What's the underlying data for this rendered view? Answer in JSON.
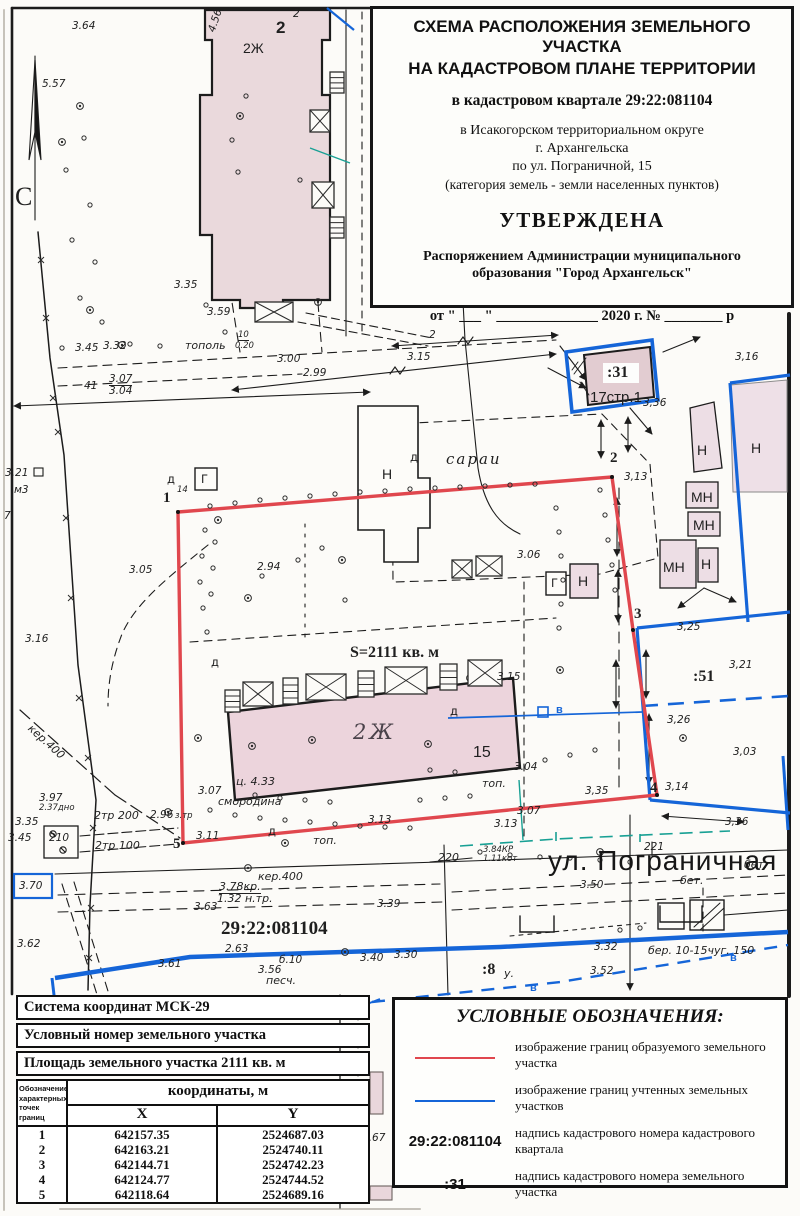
{
  "title_block": {
    "line1": "СХЕМА РАСПОЛОЖЕНИЯ ЗЕМЕЛЬНОГО УЧАСТКА",
    "line2": "НА КАДАСТРОВОМ ПЛАНЕ ТЕРРИТОРИИ",
    "quarter": "в кадастровом квартале 29:22:081104",
    "district": "в Исакогорском территориальном округе",
    "city": "г. Архангельска",
    "address": "по ул. Пограничной, 15",
    "category": "(категория земель - земли населенных пунктов)",
    "approved": "УТВЕРЖДЕНА",
    "order1": "Распоряжением Администрации муниципального",
    "order2": "образования \"Город Архангельск\"",
    "date_line": "от  \" ___ \"  ______________  2020 г.  №  ________  р"
  },
  "legend": {
    "title": "УСЛОВНЫЕ ОБОЗНАЧЕНИЯ:",
    "items": [
      {
        "type": "line-red",
        "label": "изображение границ образуемого земельного участка"
      },
      {
        "type": "line-blue",
        "label": "изображение границ учтенных земельных участков"
      },
      {
        "type": "text",
        "symbol": "29:22:081104",
        "label": "надпись кадастрового номера кадастрового квартала"
      },
      {
        "type": "text",
        "symbol": ":31",
        "label": "надпись кадастрового номера земельного участка"
      }
    ],
    "scale": "Масштаб  1 : 500"
  },
  "info_table": {
    "coord_system": "Система координат МСК-29",
    "cond_number": "Условный номер земельного участка",
    "area": "Площадь земельного участка 2111 кв. м",
    "points_header": "Обозначение характерных точек границ",
    "coords_header": "координаты, м",
    "col_x": "X",
    "col_y": "Y",
    "points": [
      {
        "n": "1",
        "x": "642157.35",
        "y": "2524687.03"
      },
      {
        "n": "2",
        "x": "642163.21",
        "y": "2524740.11"
      },
      {
        "n": "3",
        "x": "642144.71",
        "y": "2524742.23"
      },
      {
        "n": "4",
        "x": "642124.77",
        "y": "2524744.52"
      },
      {
        "n": "5",
        "x": "642118.64",
        "y": "2524689.16"
      }
    ]
  },
  "map": {
    "colors": {
      "parcel_new": "#e0474e",
      "parcel_registered": "#1565d8",
      "utility": "#18a094"
    },
    "labels": [
      {
        "t": "3.64",
        "x": 72,
        "y": 20,
        "c": ""
      },
      {
        "t": "5.57",
        "x": 42,
        "y": 78,
        "c": ""
      },
      {
        "t": "С",
        "x": 15,
        "y": 182,
        "c": "north"
      },
      {
        "t": "2",
        "x": 293,
        "y": 8,
        "c": ""
      },
      {
        "t": "2",
        "x": 276,
        "y": 18,
        "c": "nb2"
      },
      {
        "t": "2Ж",
        "x": 243,
        "y": 40,
        "c": "bld"
      },
      {
        "t": "4.56",
        "x": 206,
        "y": 30,
        "c": "",
        "r": -72
      },
      {
        "t": "3.35",
        "x": 174,
        "y": 279,
        "c": ""
      },
      {
        "t": "3.59",
        "x": 207,
        "y": 306,
        "c": ""
      },
      {
        "t": "3.45",
        "x": 75,
        "y": 342,
        "c": ""
      },
      {
        "t": "3.32",
        "x": 103,
        "y": 340,
        "c": ""
      },
      {
        "t": "тополь",
        "x": 185,
        "y": 339,
        "c": "hand"
      },
      {
        "t": "10",
        "x": 238,
        "y": 330,
        "c": "tiny frt"
      },
      {
        "t": "0.20",
        "x": 235,
        "y": 341,
        "c": "tiny"
      },
      {
        "t": "3.00",
        "x": 277,
        "y": 353,
        "c": ""
      },
      {
        "t": "2.99",
        "x": 303,
        "y": 367,
        "c": ""
      },
      {
        "t": "41",
        "x": 84,
        "y": 380,
        "c": ""
      },
      {
        "t": "3.07",
        "x": 109,
        "y": 373,
        "c": "frt"
      },
      {
        "t": "3.04",
        "x": 109,
        "y": 385,
        "c": ""
      },
      {
        "t": "2",
        "x": 429,
        "y": 329,
        "c": ""
      },
      {
        "t": "3.15",
        "x": 407,
        "y": 351,
        "c": ""
      },
      {
        "t": "3.21",
        "x": 5,
        "y": 467,
        "c": ""
      },
      {
        "t": "м3",
        "x": 14,
        "y": 484,
        "c": ""
      },
      {
        "t": "7",
        "x": 4,
        "y": 510,
        "c": ""
      },
      {
        "t": "3.05",
        "x": 129,
        "y": 564,
        "c": ""
      },
      {
        "t": "3.16",
        "x": 25,
        "y": 633,
        "c": ""
      },
      {
        "t": "1",
        "x": 163,
        "y": 490,
        "c": "nb"
      },
      {
        "t": "14",
        "x": 177,
        "y": 485,
        "c": "tiny"
      },
      {
        "t": "д",
        "x": 167,
        "y": 472,
        "c": "blds"
      },
      {
        "t": "Г",
        "x": 201,
        "y": 472,
        "c": "blds"
      },
      {
        "t": "2.94",
        "x": 257,
        "y": 561,
        "c": ""
      },
      {
        "t": "сараи",
        "x": 446,
        "y": 450,
        "c": "handlg"
      },
      {
        "t": "Н",
        "x": 382,
        "y": 466,
        "c": "bld"
      },
      {
        "t": "д",
        "x": 410,
        "y": 450,
        "c": "blds"
      },
      {
        "t": "3.06",
        "x": 517,
        "y": 549,
        "c": ""
      },
      {
        "t": "Г",
        "x": 551,
        "y": 576,
        "c": "blds"
      },
      {
        "t": "Н",
        "x": 578,
        "y": 573,
        "c": "bld"
      },
      {
        "t": "S=2111 кв. м",
        "x": 350,
        "y": 644,
        "c": "area"
      },
      {
        "t": ":31",
        "x": 607,
        "y": 364,
        "c": "pnum"
      },
      {
        "t": "17стр.1",
        "x": 590,
        "y": 389,
        "c": "b17"
      },
      {
        "t": "3,36",
        "x": 643,
        "y": 397,
        "c": ""
      },
      {
        "t": "3,16",
        "x": 735,
        "y": 351,
        "c": ""
      },
      {
        "t": "2",
        "x": 610,
        "y": 450,
        "c": "nb"
      },
      {
        "t": "3,13",
        "x": 624,
        "y": 471,
        "c": ""
      },
      {
        "t": "Н",
        "x": 697,
        "y": 442,
        "c": "bld"
      },
      {
        "t": "МН",
        "x": 691,
        "y": 489,
        "c": "bld"
      },
      {
        "t": "МН",
        "x": 693,
        "y": 517,
        "c": "bld"
      },
      {
        "t": "МН",
        "x": 663,
        "y": 559,
        "c": "bld"
      },
      {
        "t": "Н",
        "x": 701,
        "y": 556,
        "c": "bld"
      },
      {
        "t": "Н",
        "x": 751,
        "y": 440,
        "c": "bld"
      },
      {
        "t": "3",
        "x": 634,
        "y": 606,
        "c": "nb"
      },
      {
        "t": "3,25",
        "x": 677,
        "y": 621,
        "c": ""
      },
      {
        "t": ":51",
        "x": 693,
        "y": 668,
        "c": "pnum"
      },
      {
        "t": "3,21",
        "x": 729,
        "y": 659,
        "c": ""
      },
      {
        "t": "3,26",
        "x": 667,
        "y": 714,
        "c": ""
      },
      {
        "t": "3,03",
        "x": 733,
        "y": 746,
        "c": ""
      },
      {
        "t": "4",
        "x": 650,
        "y": 780,
        "c": "nb"
      },
      {
        "t": "3,14",
        "x": 665,
        "y": 781,
        "c": ""
      },
      {
        "t": "3,35",
        "x": 585,
        "y": 785,
        "c": ""
      },
      {
        "t": "3,36",
        "x": 725,
        "y": 816,
        "c": ""
      },
      {
        "t": "д",
        "x": 211,
        "y": 655,
        "c": "blds"
      },
      {
        "t": "2Ж",
        "x": 353,
        "y": 720,
        "c": "b2zh"
      },
      {
        "t": "15",
        "x": 473,
        "y": 744,
        "c": "n15"
      },
      {
        "t": "ц. 4.33",
        "x": 236,
        "y": 775,
        "c": "hand"
      },
      {
        "t": "3.07",
        "x": 198,
        "y": 785,
        "c": ""
      },
      {
        "t": "смородина",
        "x": 218,
        "y": 795,
        "c": "hand"
      },
      {
        "t": "3.15",
        "x": 497,
        "y": 671,
        "c": ""
      },
      {
        "t": "д",
        "x": 450,
        "y": 704,
        "c": "blds"
      },
      {
        "t": "в",
        "x": 556,
        "y": 704,
        "c": "wblue"
      },
      {
        "t": "3.04",
        "x": 514,
        "y": 761,
        "c": ""
      },
      {
        "t": "топ.",
        "x": 482,
        "y": 777,
        "c": "hand"
      },
      {
        "t": "3.07",
        "x": 517,
        "y": 805,
        "c": ""
      },
      {
        "t": "3.13",
        "x": 494,
        "y": 818,
        "c": ""
      },
      {
        "t": "3.13",
        "x": 368,
        "y": 814,
        "c": ""
      },
      {
        "t": "д",
        "x": 268,
        "y": 824,
        "c": "blds"
      },
      {
        "t": "топ.",
        "x": 313,
        "y": 834,
        "c": "hand"
      },
      {
        "t": "3.11",
        "x": 196,
        "y": 830,
        "c": ""
      },
      {
        "t": "5",
        "x": 173,
        "y": 836,
        "c": "nb"
      },
      {
        "t": "3.97",
        "x": 39,
        "y": 792,
        "c": ""
      },
      {
        "t": "2.37дно",
        "x": 39,
        "y": 803,
        "c": "tiny"
      },
      {
        "t": "3.35",
        "x": 15,
        "y": 816,
        "c": ""
      },
      {
        "t": "3.45",
        "x": 8,
        "y": 832,
        "c": ""
      },
      {
        "t": "210",
        "x": 49,
        "y": 832,
        "c": ""
      },
      {
        "t": "2тр 200",
        "x": 94,
        "y": 809,
        "c": "hand"
      },
      {
        "t": "2.96",
        "x": 150,
        "y": 809,
        "c": ""
      },
      {
        "t": "з.тр",
        "x": 175,
        "y": 811,
        "c": "tiny"
      },
      {
        "t": "2тр 100",
        "x": 95,
        "y": 839,
        "c": "hand"
      },
      {
        "t": "кер.400",
        "x": 34,
        "y": 722,
        "c": "hand",
        "r": 42
      },
      {
        "t": "кер.400",
        "x": 258,
        "y": 870,
        "c": "hand"
      },
      {
        "t": "3.78кр.",
        "x": 219,
        "y": 880,
        "c": "handu"
      },
      {
        "t": "1.32 н.тр.",
        "x": 217,
        "y": 892,
        "c": "hand"
      },
      {
        "t": "3.63",
        "x": 194,
        "y": 901,
        "c": ""
      },
      {
        "t": "3.39",
        "x": 377,
        "y": 898,
        "c": ""
      },
      {
        "t": "29:22:081104",
        "x": 221,
        "y": 918,
        "c": "quarter"
      },
      {
        "t": "2.63",
        "x": 225,
        "y": 943,
        "c": ""
      },
      {
        "t": "б.10",
        "x": 279,
        "y": 954,
        "c": ""
      },
      {
        "t": "3.56",
        "x": 258,
        "y": 964,
        "c": ""
      },
      {
        "t": "песч.",
        "x": 266,
        "y": 974,
        "c": "hand"
      },
      {
        "t": "3.40",
        "x": 360,
        "y": 952,
        "c": ""
      },
      {
        "t": "3.30",
        "x": 394,
        "y": 949,
        "c": ""
      },
      {
        "t": "3.70",
        "x": 19,
        "y": 880,
        "c": ""
      },
      {
        "t": "3.62",
        "x": 17,
        "y": 938,
        "c": ""
      },
      {
        "t": "3.61",
        "x": 158,
        "y": 958,
        "c": ""
      },
      {
        "t": "220",
        "x": 438,
        "y": 851,
        "c": "hand"
      },
      {
        "t": "3.84КР",
        "x": 483,
        "y": 845,
        "c": "tiny"
      },
      {
        "t": "1.11кот",
        "x": 483,
        "y": 854,
        "c": "tiny"
      },
      {
        "t": "ул. Пограничная",
        "x": 548,
        "y": 845,
        "c": "street"
      },
      {
        "t": "221",
        "x": 644,
        "y": 841,
        "c": ""
      },
      {
        "t": "бет.",
        "x": 744,
        "y": 858,
        "c": "hand"
      },
      {
        "t": "бет.",
        "x": 680,
        "y": 874,
        "c": "hand"
      },
      {
        "t": "3.50",
        "x": 580,
        "y": 879,
        "c": ""
      },
      {
        "t": "3.32",
        "x": 594,
        "y": 941,
        "c": ""
      },
      {
        "t": "3.52",
        "x": 590,
        "y": 965,
        "c": ""
      },
      {
        "t": ":8",
        "x": 482,
        "y": 961,
        "c": "pnum"
      },
      {
        "t": "у.",
        "x": 504,
        "y": 967,
        "c": "hand"
      },
      {
        "t": "бер. 10-15чуг. 150",
        "x": 648,
        "y": 944,
        "c": "hand"
      },
      {
        "t": "в",
        "x": 530,
        "y": 982,
        "c": "wblue"
      },
      {
        "t": "в",
        "x": 730,
        "y": 952,
        "c": "wblue"
      },
      {
        "t": "3.67",
        "x": 362,
        "y": 1132,
        "c": ""
      }
    ]
  }
}
